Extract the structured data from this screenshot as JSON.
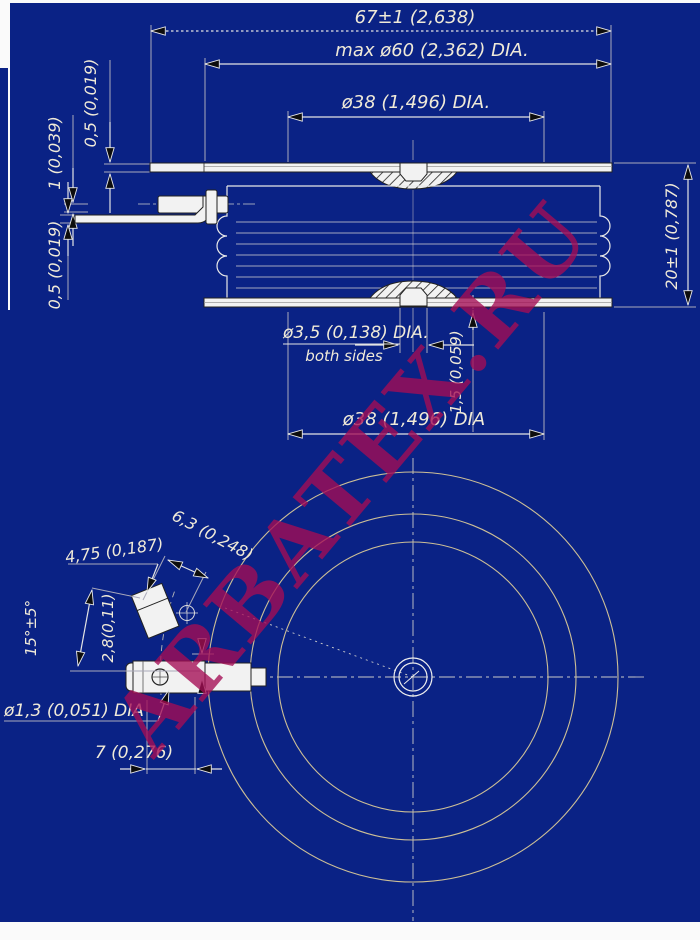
{
  "watermark": {
    "text": "ARBATEX.RU",
    "color": "#a50d55"
  },
  "colors": {
    "background": "#0a2285",
    "line": "#f2f2f2",
    "circle": "#cdbf96"
  },
  "side_view": {
    "overall_width": "67±1 (2,638)",
    "max_diameter": "max ø60 (2,362) DIA.",
    "pole_diameter_top": "ø38 (1,496) DIA.",
    "flange_thickness": "0,5 (0,019)",
    "lead_thickness": "1 (0,039)",
    "lead_strip_thickness": "0,5 (0,019)",
    "body_height": "20±1 (0,787)",
    "center_hole_diameter": "ø3,5 (0,138) DIA.",
    "center_hole_note": "both sides",
    "center_hole_depth": "1,5 (0,059)",
    "pole_diameter_bottom": "ø38 (1,496) DIA"
  },
  "bottom_view": {
    "tab_width": "4,75 (0,187)",
    "tab_length": "6,3 (0,248)",
    "lead_angle": "15°±5°",
    "lead_offset": "2,8(0,11)",
    "terminal_hole_diameter": "ø1,3 (0,051) DIA",
    "terminal_length": "7 (0,276)"
  }
}
